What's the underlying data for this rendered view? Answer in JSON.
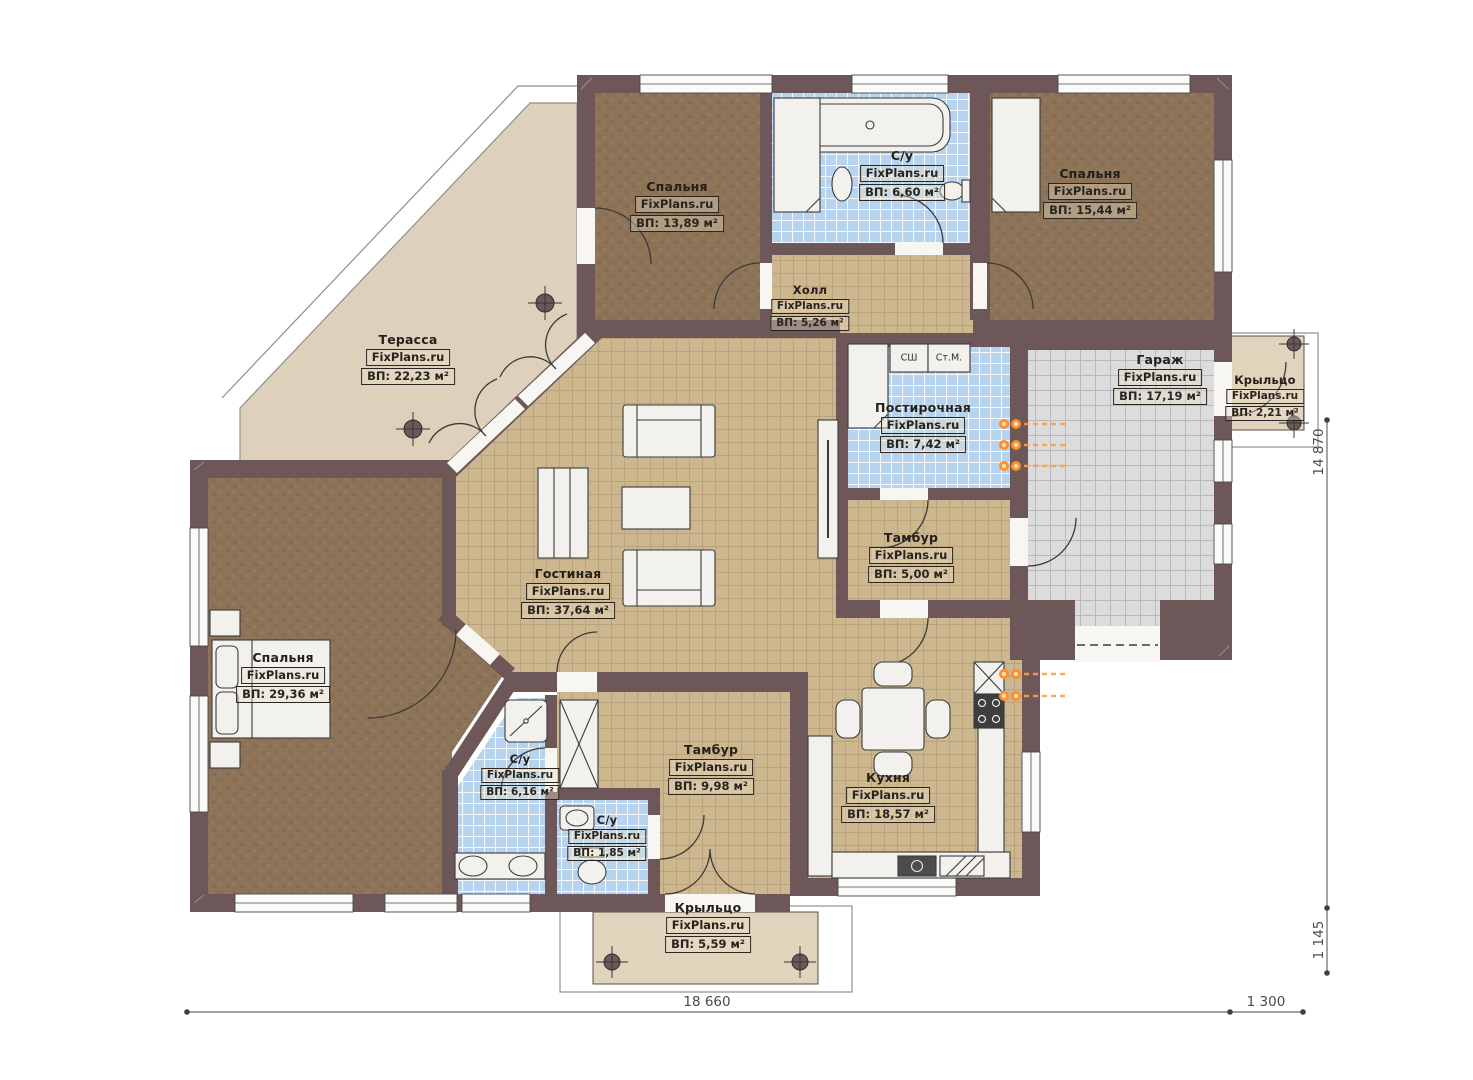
{
  "plan": {
    "brand": "FixPlans.ru",
    "rooms": [
      {
        "id": "bedroom-top-left",
        "name": "Спальня",
        "brand": "FixPlans.ru",
        "area": "ВП: 13,89 м²"
      },
      {
        "id": "bathroom-top",
        "name": "С/у",
        "brand": "FixPlans.ru",
        "area": "ВП: 6,60 м²"
      },
      {
        "id": "hall",
        "name": "Холл",
        "brand": "FixPlans.ru",
        "area": "ВП: 5,26 м²"
      },
      {
        "id": "bedroom-top-right",
        "name": "Спальня",
        "brand": "FixPlans.ru",
        "area": "ВП: 15,44 м²"
      },
      {
        "id": "terrace",
        "name": "Терасса",
        "brand": "FixPlans.ru",
        "area": "ВП: 22,23 м²"
      },
      {
        "id": "laundry",
        "name": "Постирочная",
        "brand": "FixPlans.ru",
        "area": "ВП: 7,42 м²"
      },
      {
        "id": "garage",
        "name": "Гараж",
        "brand": "FixPlans.ru",
        "area": "ВП: 17,19 м²"
      },
      {
        "id": "porch-right",
        "name": "Крыльцо",
        "brand": "FixPlans.ru",
        "area": "ВП: 2,21 м²"
      },
      {
        "id": "vestibule-small",
        "name": "Тамбур",
        "brand": "FixPlans.ru",
        "area": "ВП: 5,00 м²"
      },
      {
        "id": "living-room",
        "name": "Гостиная",
        "brand": "FixPlans.ru",
        "area": "ВП: 37,64 м²"
      },
      {
        "id": "bedroom-left",
        "name": "Спальня",
        "brand": "FixPlans.ru",
        "area": "ВП: 29,36 м²"
      },
      {
        "id": "bathroom-616",
        "name": "С/у",
        "brand": "FixPlans.ru",
        "area": "ВП: 6,16 м²"
      },
      {
        "id": "bathroom-185",
        "name": "С/у",
        "brand": "FixPlans.ru",
        "area": "ВП: 1,85 м²"
      },
      {
        "id": "vestibule-big",
        "name": "Тамбур",
        "brand": "FixPlans.ru",
        "area": "ВП: 9,98 м²"
      },
      {
        "id": "kitchen",
        "name": "Кухня",
        "brand": "FixPlans.ru",
        "area": "ВП: 18,57 м²"
      },
      {
        "id": "porch-bottom",
        "name": "Крыльцо",
        "brand": "FixPlans.ru",
        "area": "ВП: 5,59 м²"
      }
    ],
    "appliances": {
      "dryer_cabinet": "СШ",
      "washing_machine": "Ст.М."
    },
    "dimensions": {
      "width_main": "18 660",
      "width_right": "1 300",
      "height_main": "14 870",
      "height_bottom": "1 145"
    },
    "colors": {
      "wall": "#6d5758",
      "floor_tile_tan": "#cdb78e",
      "floor_tile_blue": "#b7d3ed",
      "floor_tile_grey": "#dcdcdd",
      "floor_bedroom": "#8d7458",
      "terrace": "#ddd1bb",
      "heating": "#ff8e2a"
    }
  }
}
